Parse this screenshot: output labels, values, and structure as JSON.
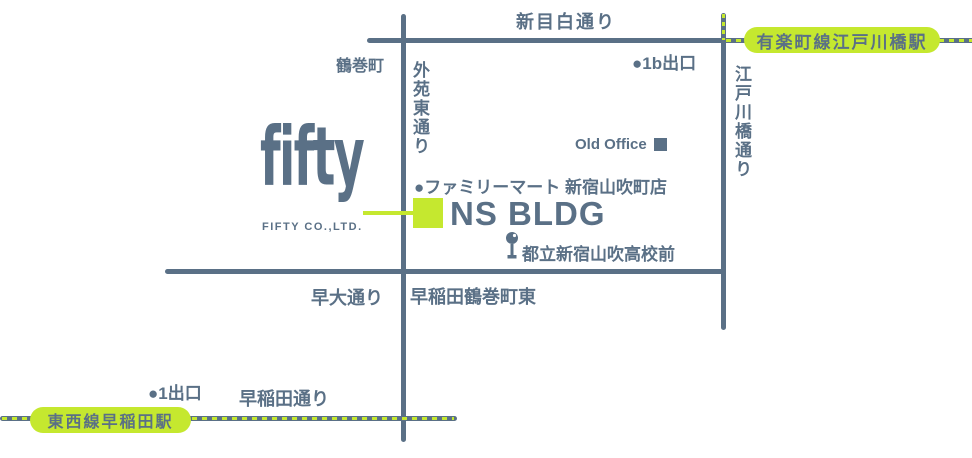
{
  "colors": {
    "road": "#5a7086",
    "accent": "#c5e82f",
    "background": "#ffffff"
  },
  "logo": {
    "name": "fifty",
    "company": "FIFTY CO.,LTD."
  },
  "building": {
    "name": "NS BLDG"
  },
  "roads": {
    "shin_mejiro": "新目白通り",
    "gaien_higashi": "外苑東通り",
    "edogawabashi": "江戸川橋通り",
    "sodai": "早大通り",
    "waseda": "早稲田通り"
  },
  "stations": {
    "edogawabashi": "有楽町線江戸川橋駅",
    "waseda": "東西線早稲田駅"
  },
  "exits": {
    "exit_1b": "1b出口",
    "exit_1": "1出口"
  },
  "landmarks": {
    "town": "鶴巻町",
    "old_office": "Old Office",
    "familymart": "ファミリーマート 新宿山吹町店",
    "bus_stop": "都立新宿山吹高校前",
    "intersection": "早稲田鶴巻町東"
  },
  "icons": {
    "dot": "●"
  }
}
